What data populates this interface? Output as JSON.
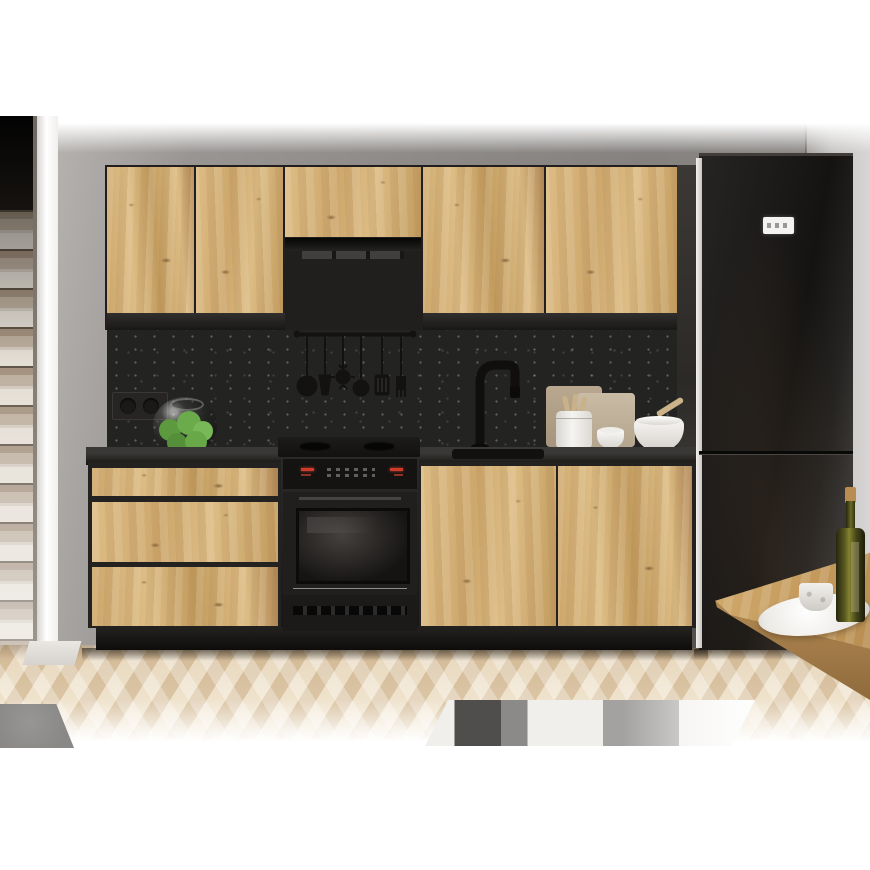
{
  "image": {
    "kind": "interior product photo (3D render)",
    "subject": "modern kitchen furniture set with artisan oak fronts and black accents",
    "visible_text": ""
  },
  "palette": {
    "page-white": "#ffffff",
    "wall-gray": "#8c8986",
    "wall-light": "#d8d6d4",
    "oak-light": "#ddbd85",
    "oak-mid": "#cda76c",
    "oak-mid2": "#c29b5e",
    "oak-dark": "#b08654",
    "carcass-black": "#232220",
    "splash-black": "#232321",
    "counter-black": "#2b2a28",
    "appliance-black": "#171615",
    "led-red": "#cf3a2a",
    "floor-light": "#ecdcc0",
    "floor-mid": "#dfcaa8",
    "rug-white": "#f1efec",
    "rug-gray": "#a3a2a0",
    "rug-dark": "#4f4e4c",
    "apple-green": "#6cab4c",
    "cork-tan": "#b98d52",
    "stair-tread": "#b4a292",
    "stair-riser": "#e4ded4",
    "column-white": "#f6f4f1"
  },
  "objects": [
    "staircase",
    "white-wall-column",
    "gray-back-wall",
    "upper-cabinet-doors-x5",
    "extractor-hood",
    "stone-backsplash",
    "utensil-rail",
    "black-faucet",
    "power-socket",
    "glass-bowl-with-green-apples",
    "black-countertop",
    "sink",
    "drawer-unit-x3",
    "black-oven-with-gas-hob",
    "base-cabinet-doors-x2",
    "cutting-boards",
    "utensil-canister",
    "small-cup",
    "mortar-bowl-with-pestle",
    "black-fridge-freezer",
    "fridge-display",
    "wood-dining-table-corner",
    "white-plate",
    "marble-cup",
    "olive-oil-bottle",
    "herringbone-parquet-floor",
    "striped-rug",
    "gray-rug-corner"
  ]
}
